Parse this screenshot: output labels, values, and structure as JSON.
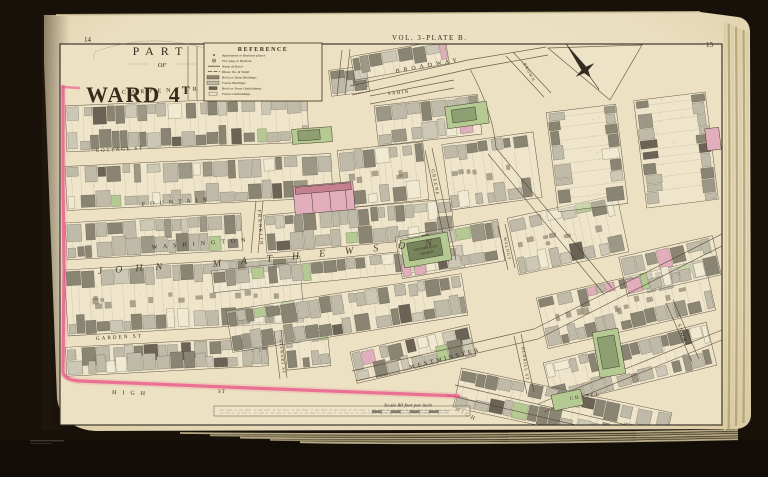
{
  "page": {
    "left_number": "14",
    "right_number": "15",
    "volume_label": "VOL. 3-PLATE B."
  },
  "title": {
    "part": "PART",
    "of": "OF",
    "ward_name": "WARD 4",
    "ward_suffix": "T"
  },
  "legend": {
    "title": "REFERENCE",
    "entries": [
      {
        "symbol": "dot",
        "label": "Apartments or Business places"
      },
      {
        "symbol": "hydrant",
        "label": "Fire plug or Hydrant"
      },
      {
        "symbol": "line",
        "label": "Name of Street"
      },
      {
        "symbol": "line",
        "label": "House No. & Width"
      },
      {
        "symbol": "swatch-brick",
        "label": "Brick or Stone Buildings"
      },
      {
        "symbol": "swatch-frame",
        "label": "Frame Buildings"
      },
      {
        "symbol": "swatch-brick-small",
        "label": "Brick or Stone Outbuildings"
      },
      {
        "symbol": "swatch-frame-outline",
        "label": "Frame Outbuildings"
      }
    ]
  },
  "scale_bar": {
    "label": "Scale 80 feet per inch"
  },
  "streets": [
    {
      "id": "carpenter",
      "label": "CARPENTER"
    },
    {
      "id": "cottage",
      "label": "COTTAGE ST"
    },
    {
      "id": "fountain",
      "label": "FOUNTAIN"
    },
    {
      "id": "washington",
      "label": "WASHINGTON"
    },
    {
      "id": "franklin",
      "label": "FRANKLIN"
    },
    {
      "id": "garden",
      "label": "GARDEN ST"
    },
    {
      "id": "high",
      "label": "HIGH"
    },
    {
      "id": "high_st_suffix",
      "label": "ST"
    },
    {
      "id": "high_lower",
      "label": "HIGH"
    },
    {
      "id": "westminster",
      "label": "WESTMINSTER"
    },
    {
      "id": "chapel",
      "label": "CHAPEL"
    },
    {
      "id": "burrill",
      "label": "BURRILL ST"
    },
    {
      "id": "snow",
      "label": "SNOW"
    },
    {
      "id": "broadway",
      "label": "BROADWAY"
    },
    {
      "id": "sabin",
      "label": "SABIN"
    },
    {
      "id": "brown",
      "label": "BROWN"
    },
    {
      "id": "greene",
      "label": "GREENE"
    },
    {
      "id": "walnut",
      "label": "WALNUT"
    },
    {
      "id": "stewart",
      "label": "STEWART ST"
    }
  ],
  "district_letters": {
    "west": "JOHN",
    "east": "MATHEWSON"
  },
  "landmarks": {
    "church_line1": "UNIVERSALIST",
    "church_line2": "CHURCH"
  },
  "colors": {
    "boundary": "#e94e84",
    "frame_building": "#c0baa9",
    "brick_building": "#8a8473",
    "dark_building": "#6b6456",
    "pink_building": "#e2aebc",
    "green_building": "#b5c992",
    "paper": "#e9dec0",
    "line": "#3e3323"
  }
}
